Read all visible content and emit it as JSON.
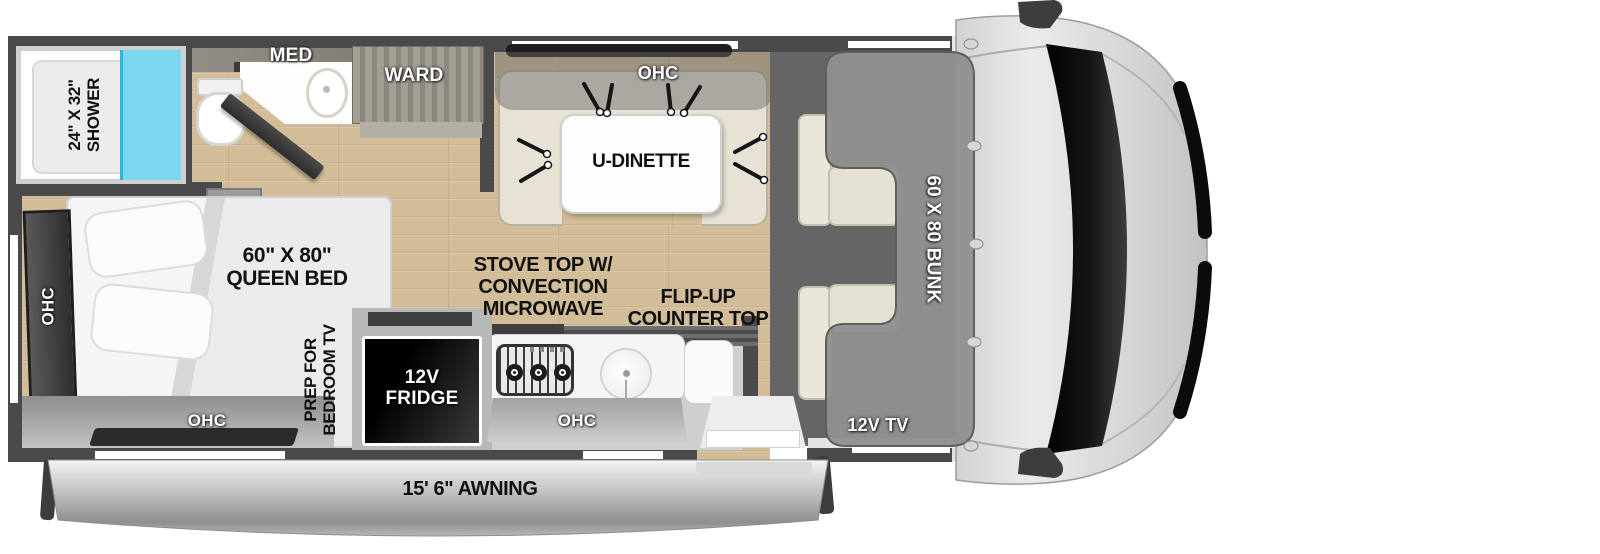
{
  "diagram_title": "RV floor plan with cab-over bunk",
  "rooms": {
    "bathroom": {
      "shower_size": "24\" X 32\"",
      "shower": "SHOWER",
      "med": "MED",
      "ward": "WARD"
    },
    "bedroom": {
      "bed_size": "60\" X 80\"",
      "bed": "QUEEN BED",
      "ohc_left": "OHC",
      "ohc_rear": "OHC",
      "tv_prep_line1": "PREP FOR",
      "tv_prep_line2": "BEDROOM TV"
    },
    "dinette": {
      "ohc": "OHC",
      "table": "U-DINETTE"
    },
    "kitchen": {
      "stove_line1": "STOVE TOP W/",
      "stove_line2": "CONVECTION",
      "stove_line3": "MICROWAVE",
      "flip_line1": "FLIP-UP",
      "flip_line2": "COUNTER TOP",
      "fridge_line1": "12V",
      "fridge_line2": "FRIDGE",
      "ohc": "OHC"
    },
    "cab": {
      "bunk": "60 X 80 BUNK",
      "tv": "12V TV"
    },
    "exterior": {
      "awning": "15' 6\" AWNING"
    }
  },
  "colors": {
    "wall": "#4a4a4a",
    "wood_floor": "#d3bd98",
    "shower_glass": "#7bd6f0",
    "dinette_bench": "#e7e2d3",
    "bunk_overlay": "#909090",
    "cab_floor": "#656565",
    "fridge": "#000000",
    "awning": "#bdbdbd",
    "label_dark": "#111111",
    "label_light": "#ffffff"
  }
}
